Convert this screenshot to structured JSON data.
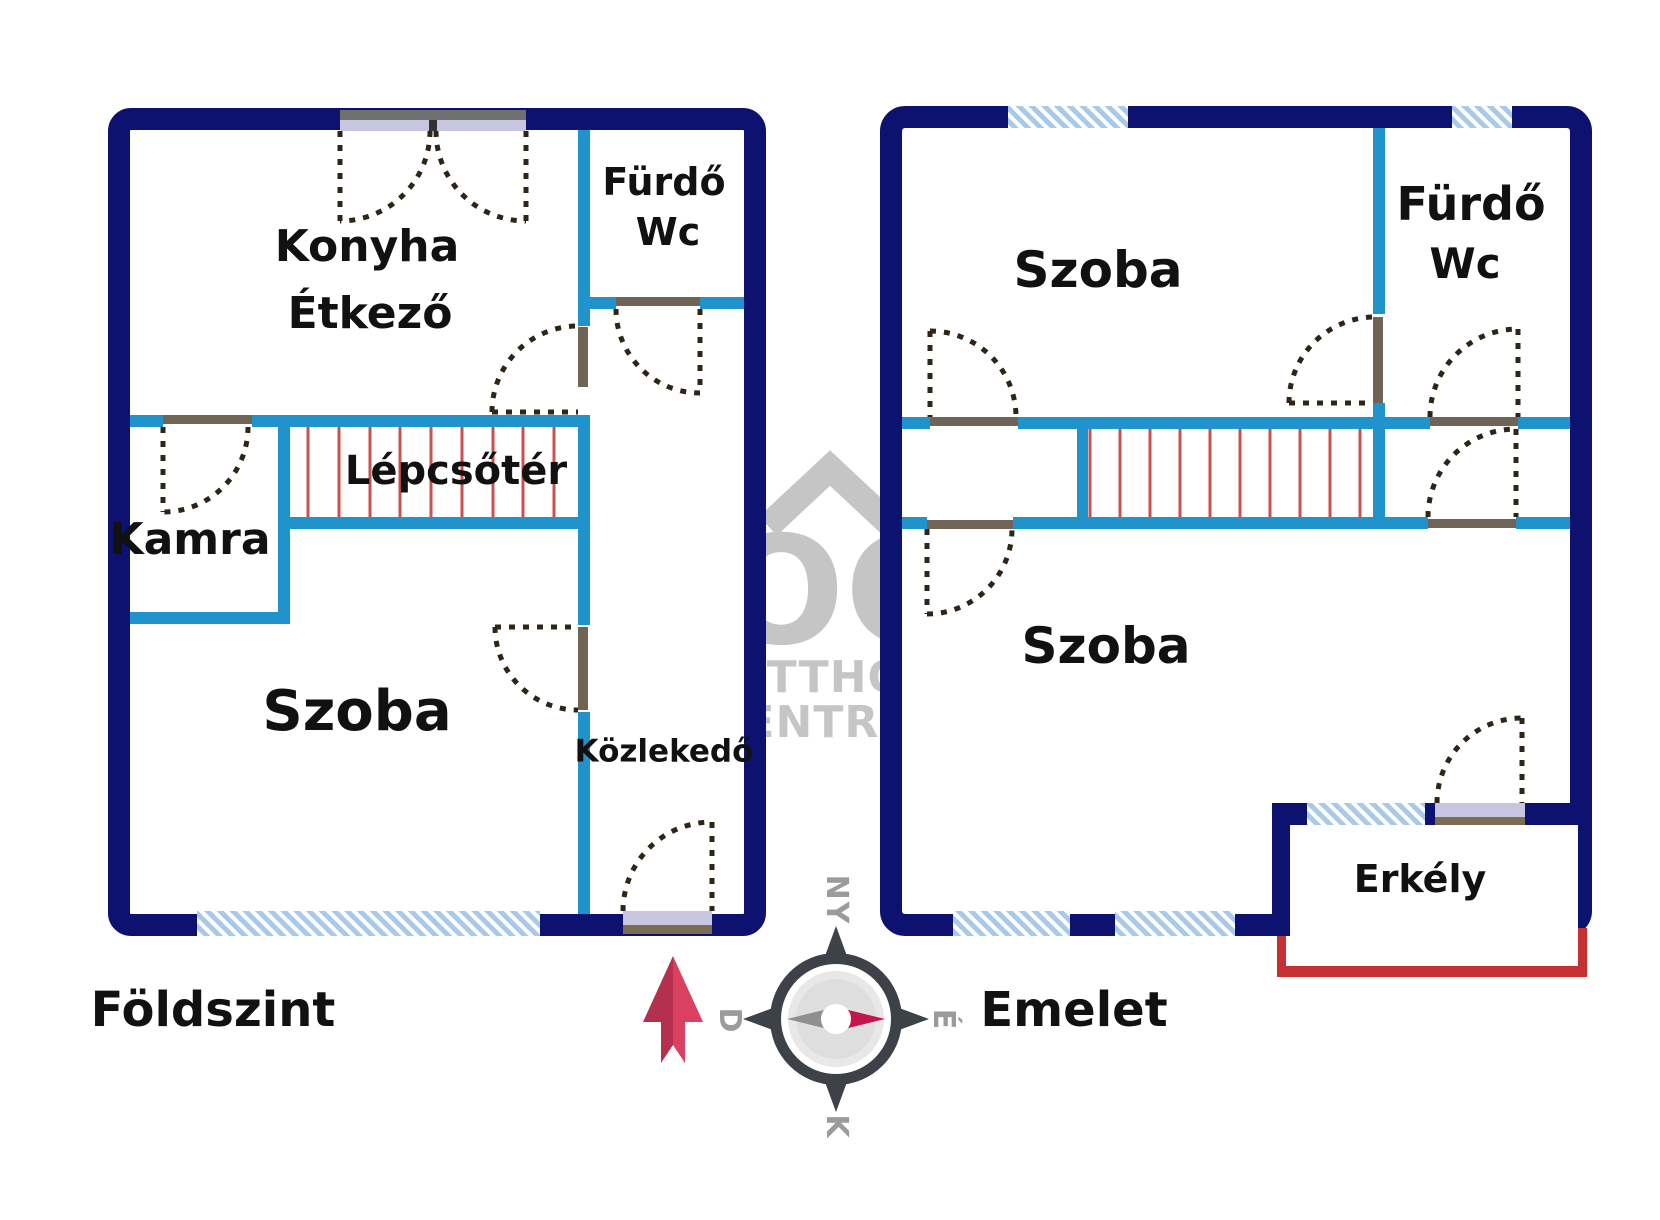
{
  "floors": {
    "left": {
      "name": "Földszint",
      "rooms": {
        "konyha": "Konyha",
        "etkezo": "Étkező",
        "furdo": "Fürdő",
        "wc": "Wc",
        "lepcsoter": "Lépcsőtér",
        "kamra": "Kamra",
        "szoba": "Szoba",
        "kozlekedo": "Közlekedő"
      }
    },
    "right": {
      "name": "Emelet",
      "rooms": {
        "szoba_felso": "Szoba",
        "furdo": "Fürdő",
        "wc": "Wc",
        "szoba_also": "Szoba",
        "erkely": "Erkély"
      }
    }
  },
  "compass": {
    "top": "NY",
    "left": "D",
    "right": "É",
    "bottom": "K"
  },
  "watermark": {
    "oc": "OC",
    "line1": "OTTHON",
    "line2": "CENTRUM"
  },
  "colors": {
    "navy": "#0d1170",
    "teal": "#2193cc",
    "stair": "#c9514f",
    "red": "#c63032",
    "hatch_bg": "#a9c9e9",
    "sill": "#c6c6e0",
    "sill_brown": "#7b6c55",
    "leaf": "#6f6456",
    "dash": "#2e2418",
    "wm": "#c5c5c5",
    "compass_dark": "#3d4148",
    "compass_needle_gray": "#8f8f8f",
    "compass_needle_red": "#c4164c",
    "compass_label": "#9b9b9b",
    "arrow_dark": "#b5304e",
    "arrow_light": "#da4160",
    "label": "#111111"
  }
}
